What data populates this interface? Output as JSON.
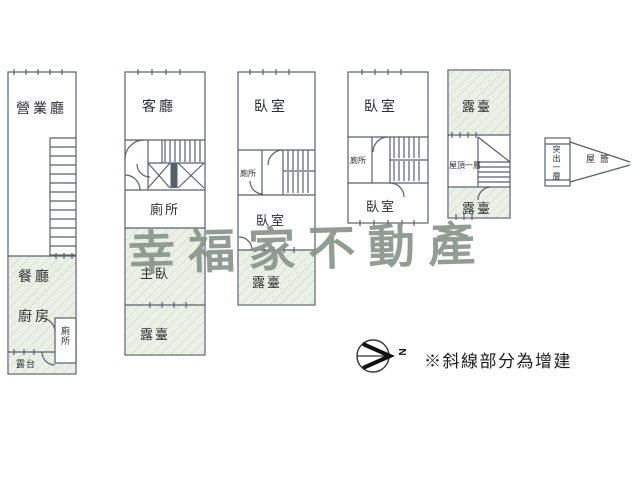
{
  "meta": {
    "background": "#ffffff",
    "wall_color": "#56616d",
    "hatch_fill": "#eaf0e6",
    "hatch_line": "#c9d7c5",
    "watermark_color": "#89968b",
    "note_color": "#1c1c1c"
  },
  "watermark": {
    "text": "幸福家不動產"
  },
  "note": {
    "text": "※斜線部分為增建"
  },
  "compass": {
    "label": "N"
  },
  "units": {
    "unit1": {
      "rooms": {
        "hall": "營業廳",
        "dining": "餐廳",
        "kitchen": "廚房",
        "toilet": "廁所",
        "terrace": "露台"
      }
    },
    "unit2": {
      "rooms": {
        "living": "客廳",
        "toilet": "廁所",
        "master": "主臥",
        "terrace": "露臺"
      }
    },
    "unit3": {
      "rooms": {
        "bedroom_top": "臥室",
        "toilet": "廁所",
        "bedroom_bottom": "臥室",
        "terrace": "露臺"
      }
    },
    "unit4": {
      "rooms": {
        "bedroom_top": "臥室",
        "toilet": "廁所",
        "bedroom_bottom": "臥室"
      }
    },
    "unit5": {
      "rooms": {
        "terrace_top": "露臺",
        "roof": "屋頂一層",
        "terrace_bottom": "露臺"
      }
    },
    "annex": {
      "label": "突出一層",
      "eave": "屋簷"
    }
  }
}
